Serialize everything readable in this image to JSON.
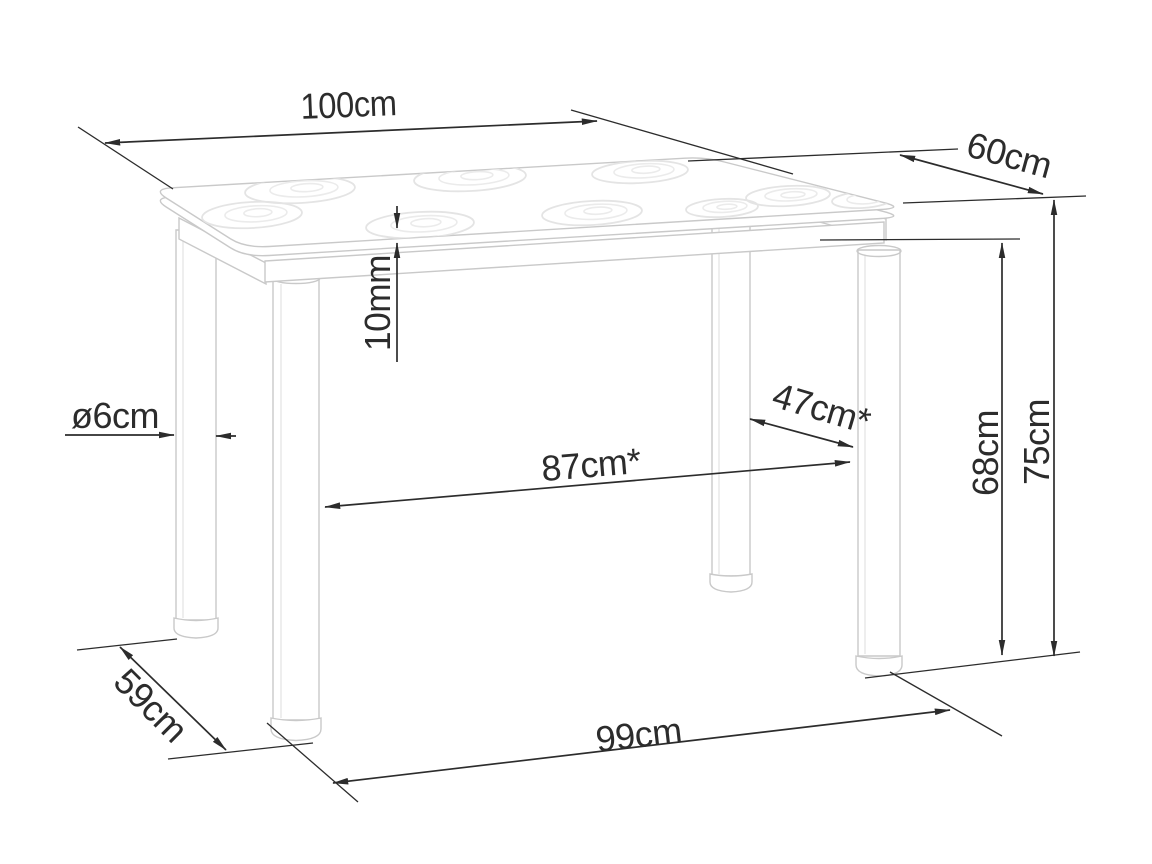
{
  "drawing": {
    "background_color": "#ffffff",
    "ink_color": "#2c2c2c",
    "furniture_line_color": "#c9c9c9",
    "pattern_line_color": "#e4e4e4",
    "labels": {
      "top_length": "100cm",
      "top_depth": "60cm",
      "glass_thickness": "10mm",
      "leg_diameter": "ø6cm",
      "leg_spacing_length": "87cm*",
      "leg_spacing_depth": "47cm*",
      "leg_height": "68cm",
      "total_height": "75cm",
      "floor_depth": "59cm",
      "floor_length": "99cm"
    }
  }
}
